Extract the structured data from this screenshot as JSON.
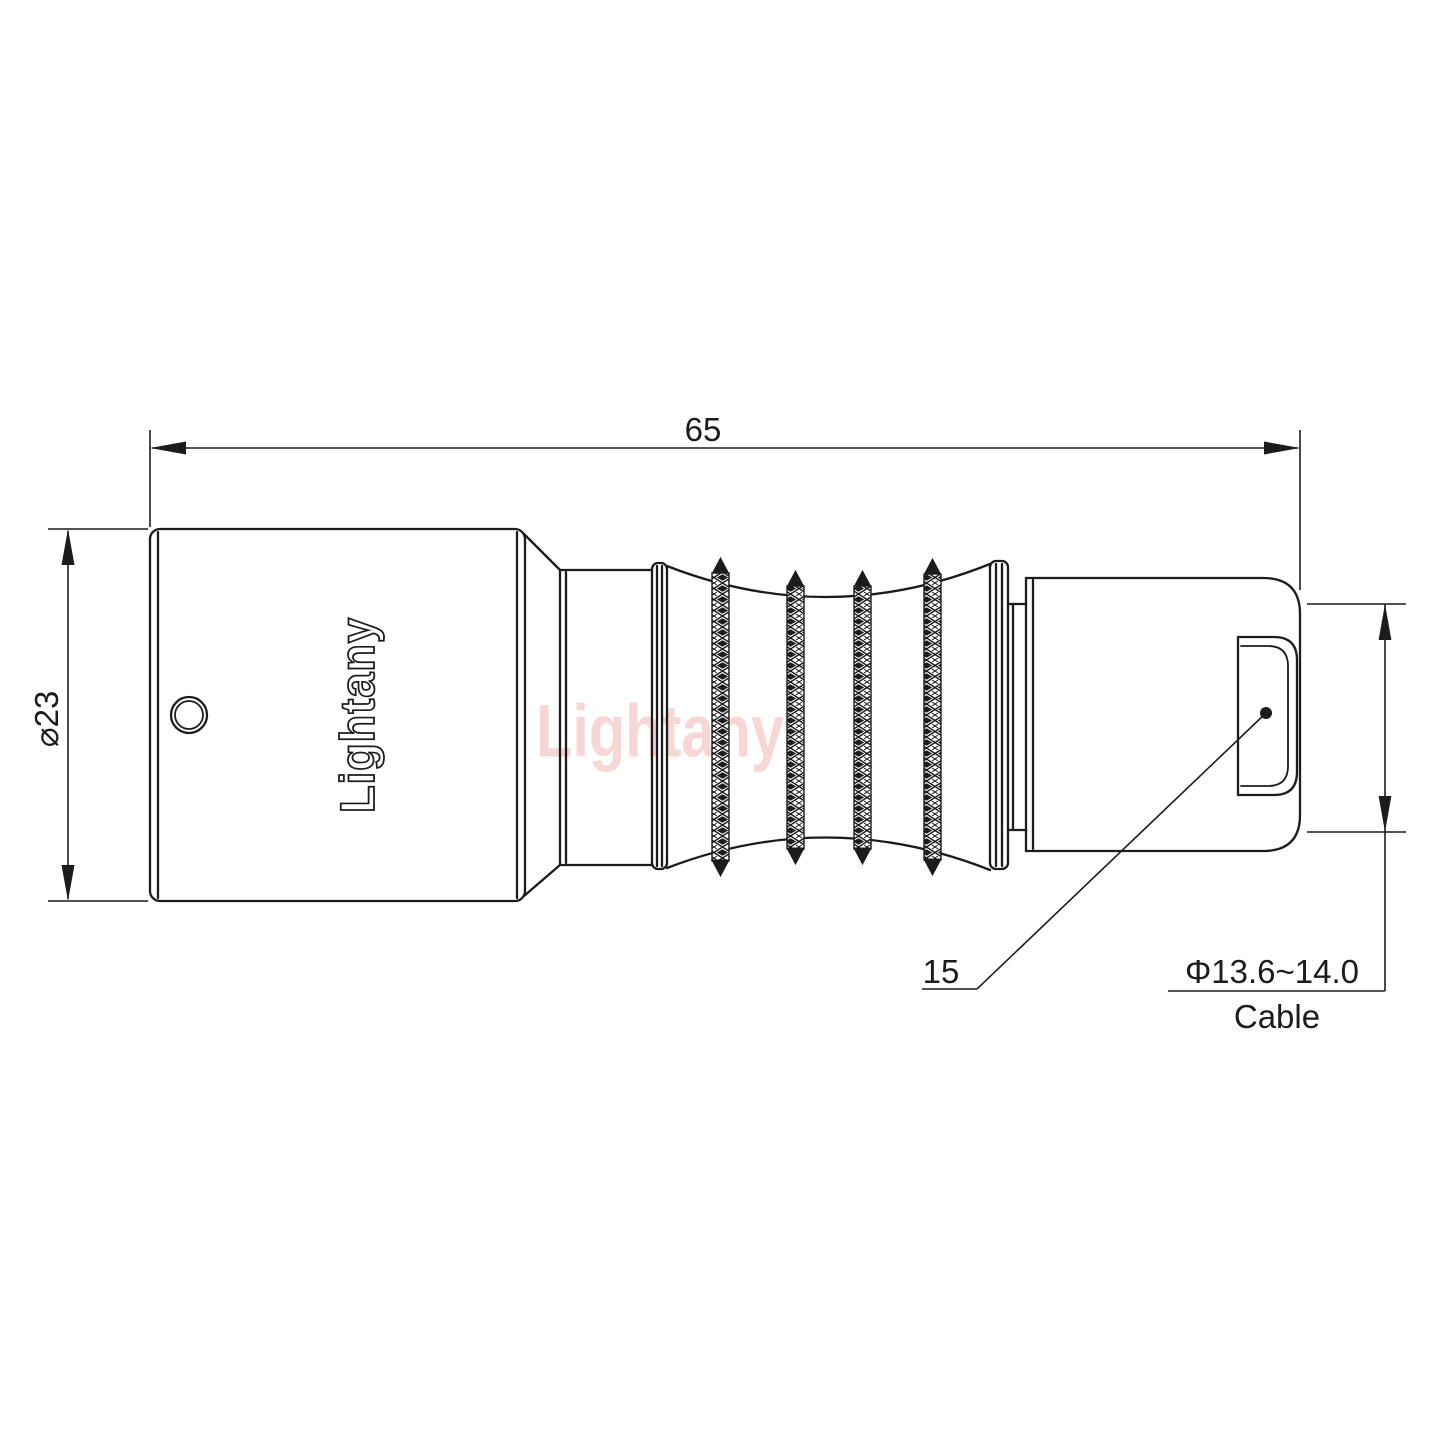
{
  "drawing": {
    "watermark_text": "Lightany",
    "brand_engraving": "Lightany",
    "dimensions": {
      "overall_length": "65",
      "body_diameter": "⌀23",
      "cable_nut_length": "15",
      "cable_range": "Φ13.6~14.0",
      "cable_label": "Cable"
    },
    "colors": {
      "line": "#1c1c1c",
      "watermark": "#f2b6b6",
      "background": "#ffffff"
    }
  }
}
